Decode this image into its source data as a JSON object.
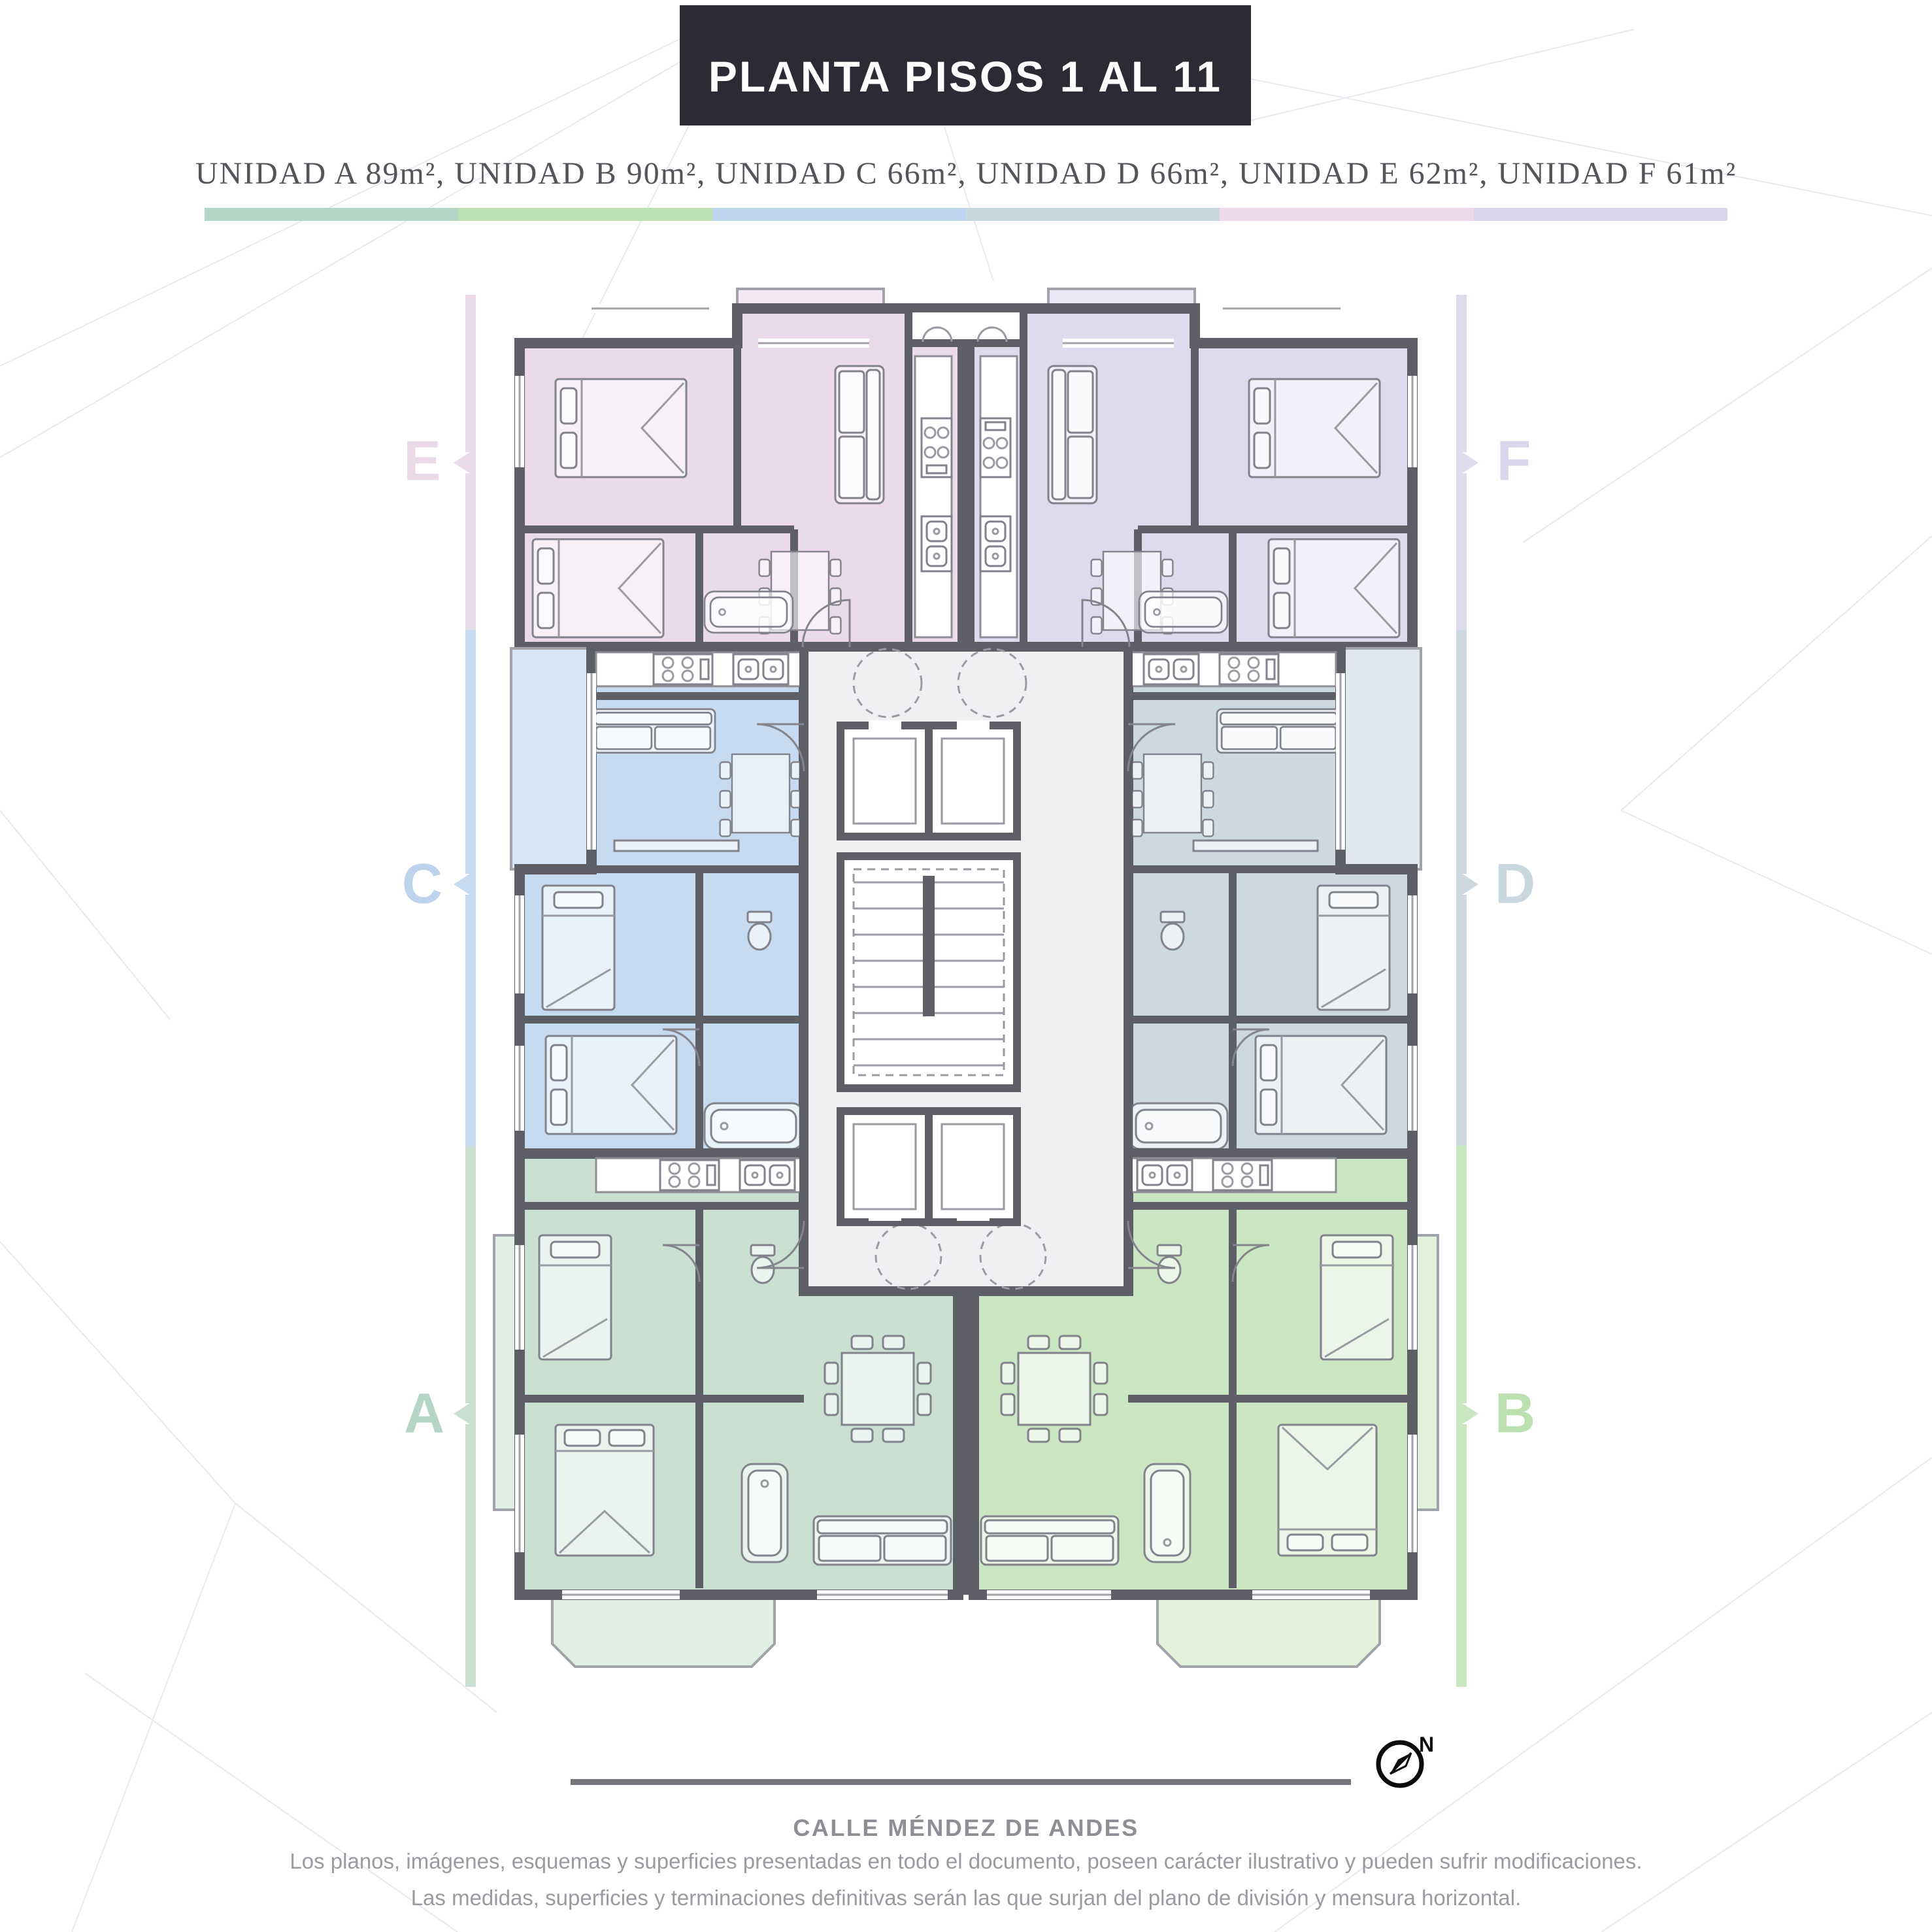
{
  "palette": {
    "ink": "#2b2b36",
    "wall": "#5e5e66",
    "core": "#eff0f2",
    "mesh": "#e9e9ef",
    "furn": "#82828c",
    "text-dark": "#54545b",
    "text-gray": "#9a9aa0",
    "street-line": "#74747b",
    "street-text": "#8e8e94",
    "unit-a": "#c9e0d2",
    "unit-a-light": "#deeee2",
    "unit-b": "#cbe6c2",
    "unit-b-light": "#e2f2da",
    "unit-c": "#c6daf0",
    "unit-c-light": "#d8e6f7",
    "unit-d": "#cdd9e1",
    "unit-d-light": "#e0e8ee",
    "unit-e": "#ebdaea",
    "unit-e-light": "#f3e7f2",
    "unit-f": "#dddbee",
    "unit-f-light": "#eae8f6"
  },
  "title": "PLANTA PISOS 1 AL 11",
  "subtitle": "UNIDAD A 89m², UNIDAD B 90m², UNIDAD C 66m², UNIDAD D 66m², UNIDAD E 62m², UNIDAD F 61m²",
  "units": [
    {
      "letter": "A",
      "area": "89m²",
      "color": "#b5d6c6"
    },
    {
      "letter": "B",
      "area": "90m²",
      "color": "#bce0b0"
    },
    {
      "letter": "C",
      "area": "66m²",
      "color": "#bdd4ec"
    },
    {
      "letter": "D",
      "area": "66m²",
      "color": "#c9d7de"
    },
    {
      "letter": "E",
      "area": "62m²",
      "color": "#ecd9e8"
    },
    {
      "letter": "F",
      "area": "61m²",
      "color": "#d8d6eb"
    }
  ],
  "street": {
    "label": "CALLE MÉNDEZ DE ANDES"
  },
  "compass": {
    "north_label": "N"
  },
  "disclaimer": {
    "line1": "Los planos, imágenes, esquemas y superficies presentadas en todo el documento, poseen carácter ilustrativo y pueden sufrir modificaciones.",
    "line2": "Las medidas, superficies y terminaciones definitivas serán las que surjan del plano de división y mensura horizontal."
  }
}
